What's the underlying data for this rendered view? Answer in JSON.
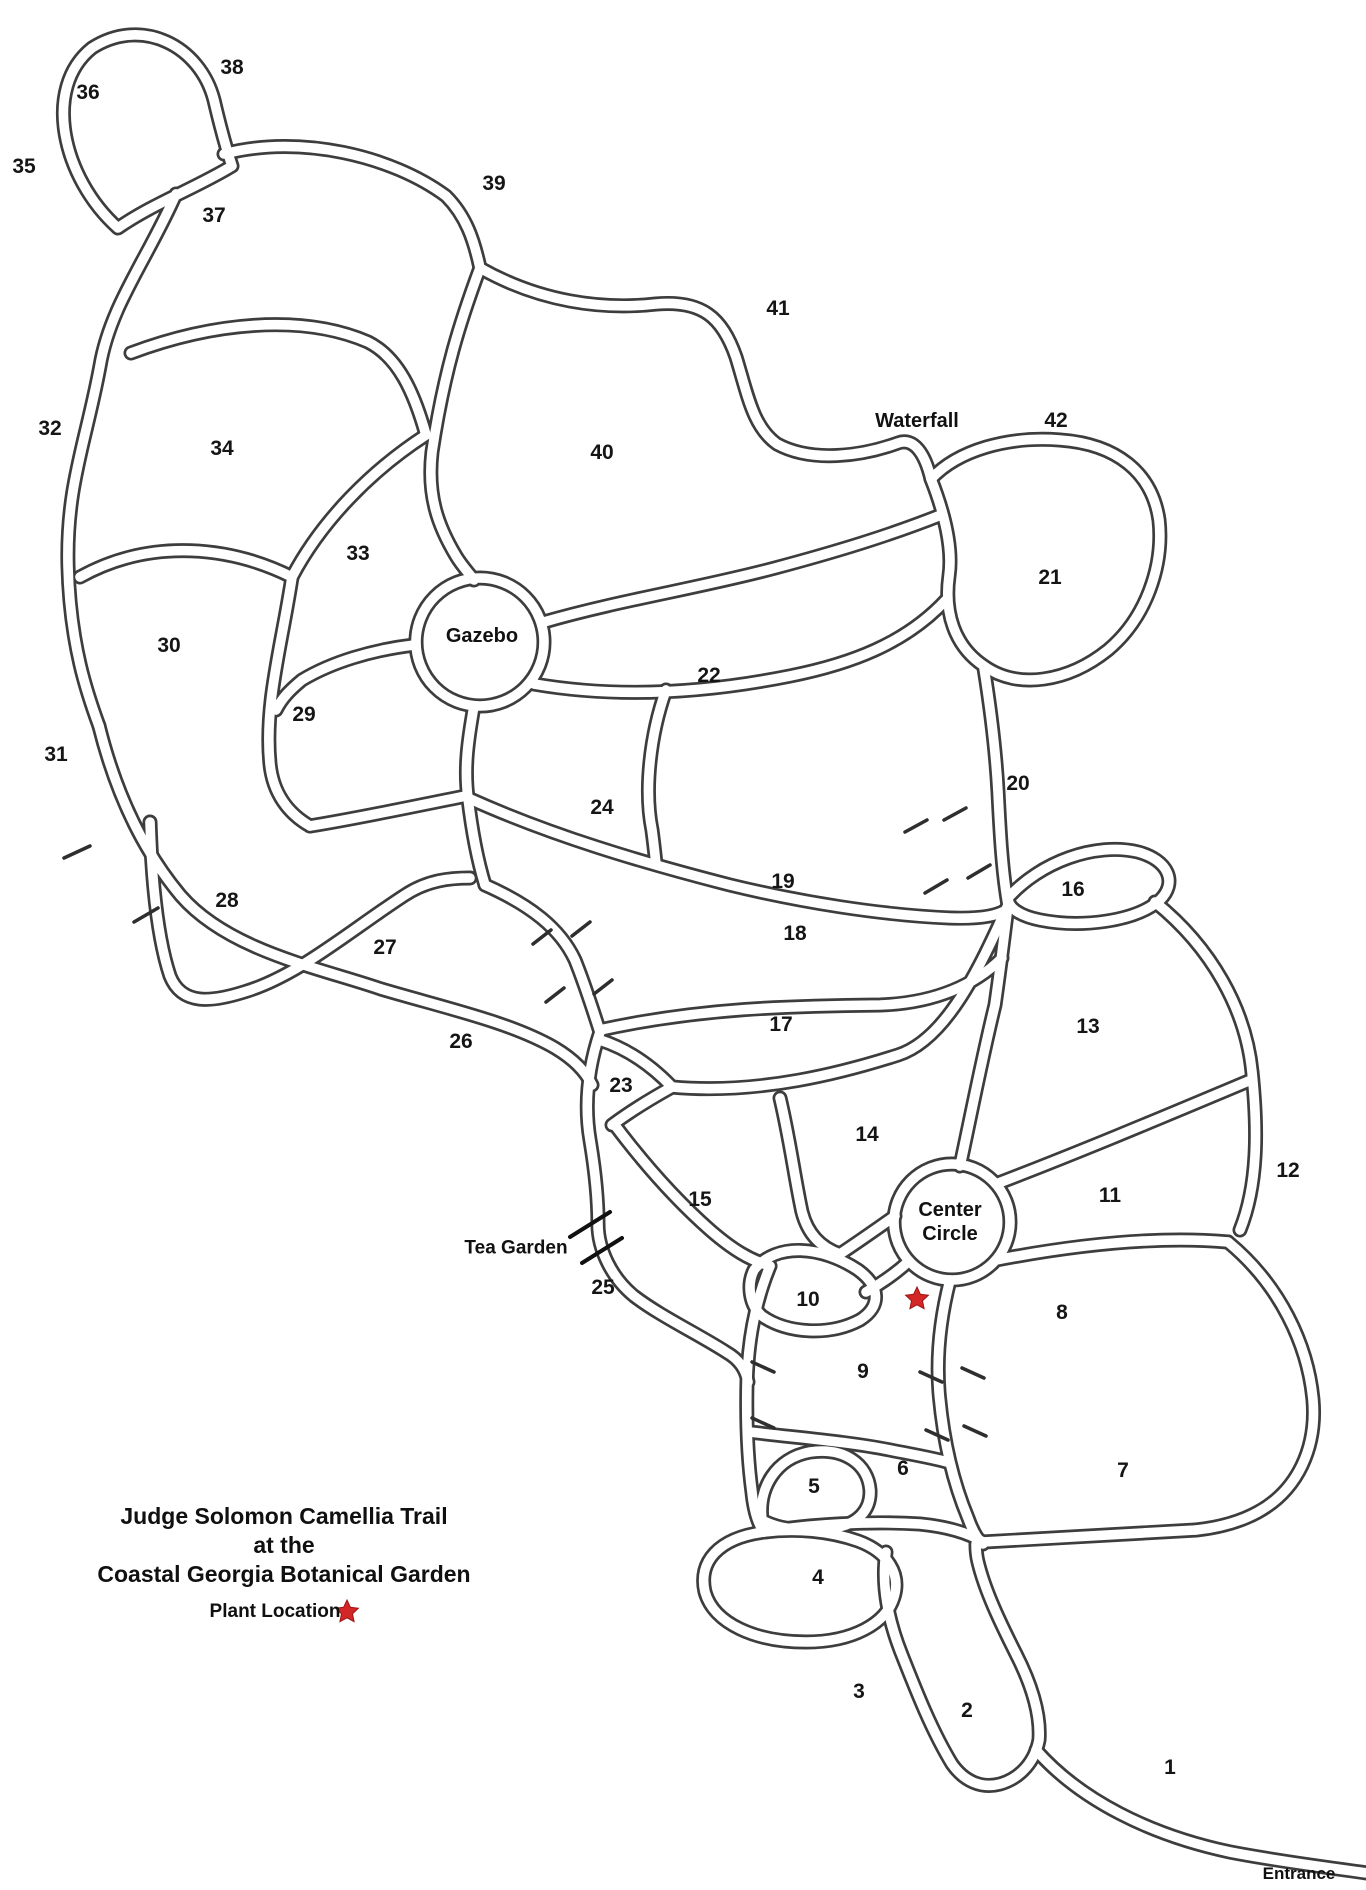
{
  "title": {
    "line1": "Judge Solomon Camellia Trail",
    "line2": "at the",
    "line3": "Coastal Georgia Botanical Garden"
  },
  "legend": {
    "label": "Plant Location",
    "star_color": "#d32626"
  },
  "map": {
    "ink_color": "#3d3d3d",
    "bed_labels": [
      {
        "n": "1",
        "x": 1170,
        "y": 1768
      },
      {
        "n": "2",
        "x": 967,
        "y": 1711
      },
      {
        "n": "3",
        "x": 859,
        "y": 1692
      },
      {
        "n": "4",
        "x": 818,
        "y": 1578
      },
      {
        "n": "5",
        "x": 814,
        "y": 1487
      },
      {
        "n": "6",
        "x": 903,
        "y": 1469
      },
      {
        "n": "7",
        "x": 1123,
        "y": 1471
      },
      {
        "n": "8",
        "x": 1062,
        "y": 1313
      },
      {
        "n": "9",
        "x": 863,
        "y": 1372
      },
      {
        "n": "10",
        "x": 808,
        "y": 1300
      },
      {
        "n": "11",
        "x": 1110,
        "y": 1196
      },
      {
        "n": "12",
        "x": 1288,
        "y": 1171
      },
      {
        "n": "13",
        "x": 1088,
        "y": 1027
      },
      {
        "n": "14",
        "x": 867,
        "y": 1135
      },
      {
        "n": "15",
        "x": 700,
        "y": 1200
      },
      {
        "n": "16",
        "x": 1073,
        "y": 890
      },
      {
        "n": "17",
        "x": 781,
        "y": 1025
      },
      {
        "n": "18",
        "x": 795,
        "y": 934
      },
      {
        "n": "19",
        "x": 783,
        "y": 882
      },
      {
        "n": "20",
        "x": 1018,
        "y": 784
      },
      {
        "n": "21",
        "x": 1050,
        "y": 578
      },
      {
        "n": "22",
        "x": 709,
        "y": 676
      },
      {
        "n": "23",
        "x": 621,
        "y": 1086
      },
      {
        "n": "24",
        "x": 602,
        "y": 808
      },
      {
        "n": "25",
        "x": 603,
        "y": 1288
      },
      {
        "n": "26",
        "x": 461,
        "y": 1042
      },
      {
        "n": "27",
        "x": 385,
        "y": 948
      },
      {
        "n": "28",
        "x": 227,
        "y": 901
      },
      {
        "n": "29",
        "x": 304,
        "y": 715
      },
      {
        "n": "30",
        "x": 169,
        "y": 646
      },
      {
        "n": "31",
        "x": 56,
        "y": 755
      },
      {
        "n": "32",
        "x": 50,
        "y": 429
      },
      {
        "n": "33",
        "x": 358,
        "y": 554
      },
      {
        "n": "34",
        "x": 222,
        "y": 449
      },
      {
        "n": "35",
        "x": 24,
        "y": 167
      },
      {
        "n": "36",
        "x": 88,
        "y": 93
      },
      {
        "n": "37",
        "x": 214,
        "y": 216
      },
      {
        "n": "38",
        "x": 232,
        "y": 68
      },
      {
        "n": "39",
        "x": 494,
        "y": 184
      },
      {
        "n": "40",
        "x": 602,
        "y": 453
      },
      {
        "n": "41",
        "x": 778,
        "y": 309
      },
      {
        "n": "42",
        "x": 1056,
        "y": 421
      }
    ],
    "place_labels": [
      {
        "name": "waterfall",
        "text": "Waterfall",
        "x": 917,
        "y": 421
      },
      {
        "name": "gazebo",
        "text": "Gazebo",
        "x": 482,
        "y": 636
      },
      {
        "name": "center-circle",
        "text": "Center\nCircle",
        "x": 950,
        "y": 1222
      },
      {
        "name": "tea-garden",
        "text": "Tea Garden",
        "x": 516,
        "y": 1249
      },
      {
        "name": "entrance",
        "text": "Entrance",
        "x": 1299,
        "y": 1874
      }
    ],
    "plant_location": {
      "x": 917,
      "y": 1299
    },
    "legend_star": {
      "x": 347,
      "y": 1612
    }
  }
}
